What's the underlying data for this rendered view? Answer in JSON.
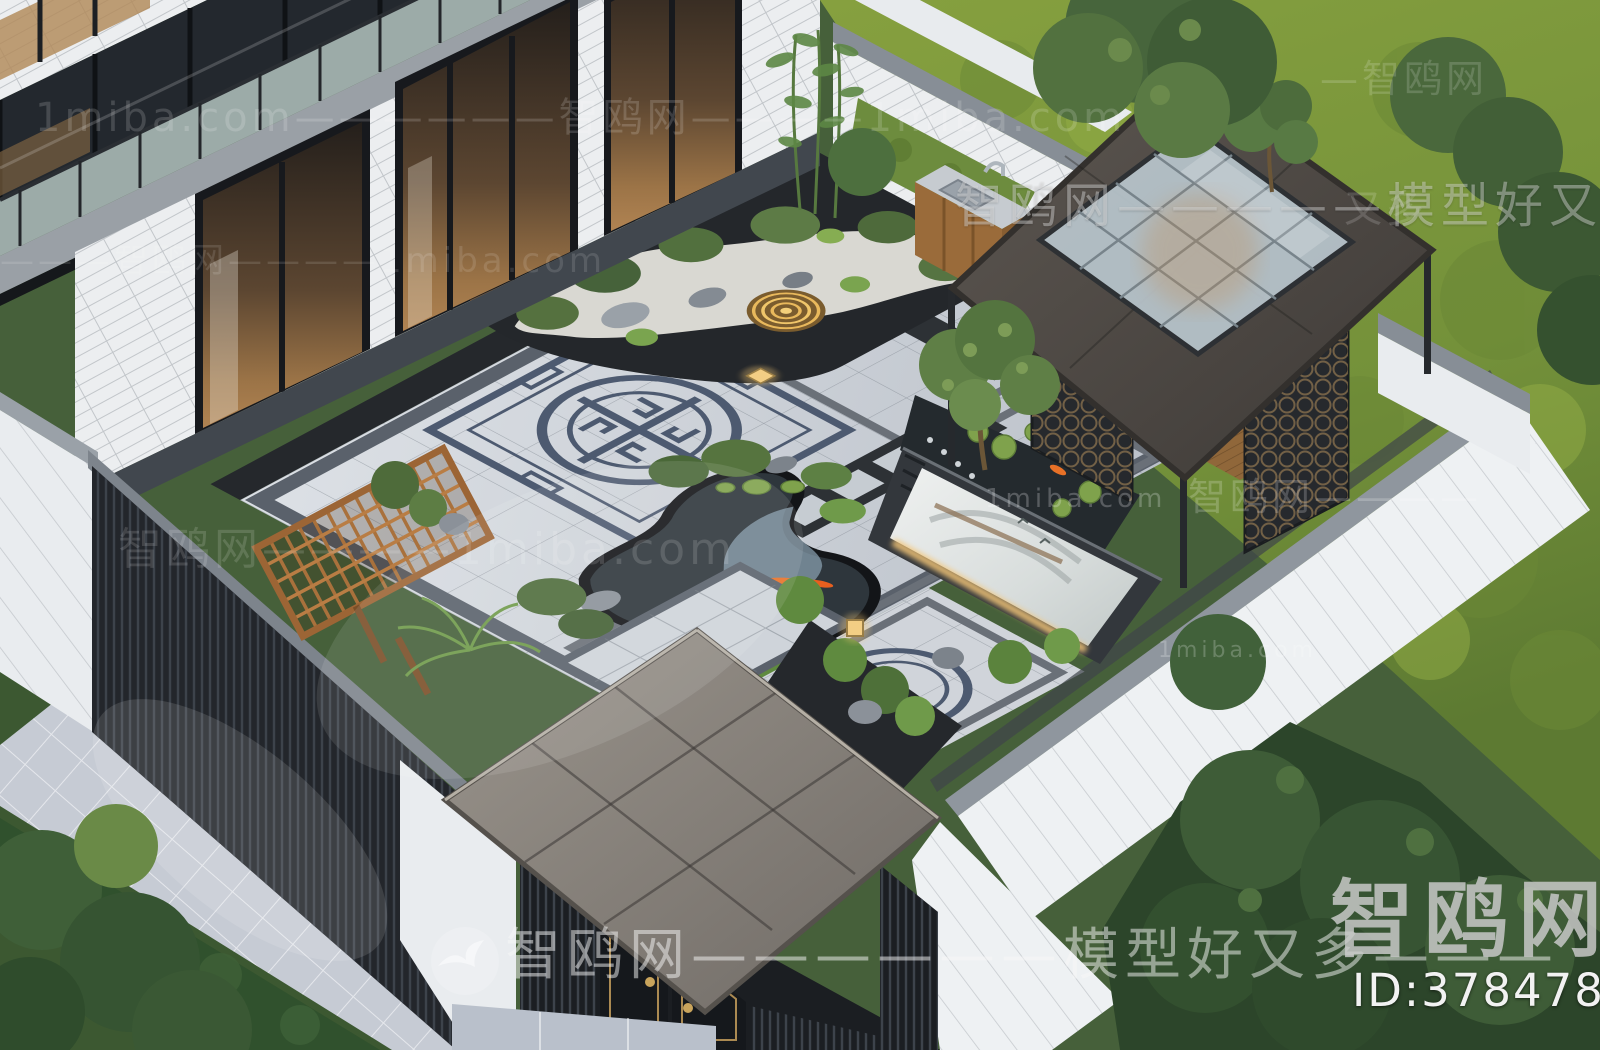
{
  "scene": {
    "description": "Aerial 3D rendering of a modern Chinese-style villa courtyard: white two-story house with black window frames and glass balcony, granite-paved courtyard with a traditional medallion inlay, zen gravel garden with golden ripple feature, koi pond with lily pads, marble landscape feature wall, wooden tea pavilion with glass skylight, outdoor kitchen, dark slatted fences, entrance gate with gray canopy and black-gold doors, hedges, lawns and trees outside the walls",
    "features": [
      "house-facade",
      "balcony",
      "courtyard-paving",
      "medallion-inlay",
      "zen-gravel-garden",
      "koi-pond",
      "feature-wall-mural",
      "tea-pavilion",
      "skylight",
      "outdoor-kitchen",
      "pergola-trellis",
      "entrance-gate",
      "perimeter-wall",
      "sidewalk",
      "hedges",
      "lawn",
      "trees",
      "bamboo",
      "lanterns"
    ]
  },
  "watermarks": {
    "corner_site_name": "智鸥网",
    "corner_id": "ID:378478056",
    "logo_icon": "seagull-circle-logo",
    "slogan_bottom": "智鸥网——————模型好又多———",
    "slogan_top": "智鸥网—————模型好又多—",
    "tile_rows": {
      "r1": "1miba.com——————智鸥网————1miba.com",
      "r2": "———智鸥网————1miba.com",
      "r3": "智鸥网————1miba.com",
      "r4": "1miba.com",
      "r5": "1miba.com",
      "r6": "智鸥网————",
      "r7": "—智鸥网",
      "r8": "又多"
    }
  },
  "colors": {
    "watermark_white": "rgba(255,255,255,0.5)",
    "paving_light": "#d3d7dc",
    "border_band": "#5a616b",
    "roof_gray": "#524d49",
    "wood": "#b9854a",
    "koi_orange": "#e87127",
    "lawn_green": "#7e9a3d",
    "gold_trim": "#ab8a52"
  }
}
